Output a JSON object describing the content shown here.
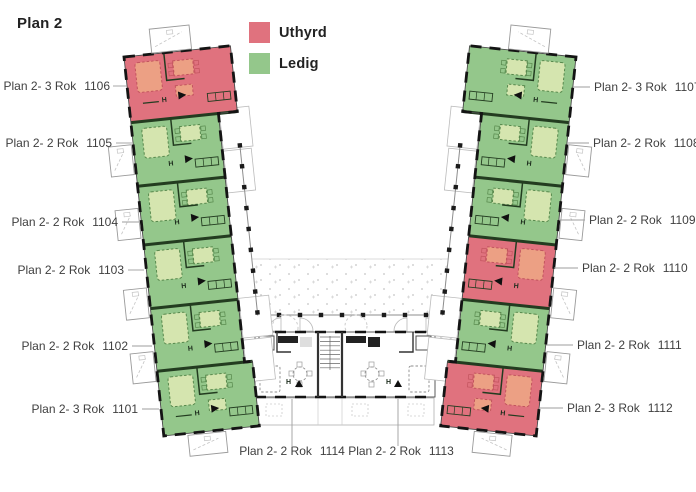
{
  "title": "Plan 2",
  "legend": {
    "items": [
      {
        "id": "uthyrd",
        "label": "Uthyrd",
        "color": "#e0727e"
      },
      {
        "id": "ledig",
        "label": "Ledig",
        "color": "#94c78b"
      }
    ]
  },
  "colors": {
    "uthyrd": "#e0727e",
    "ledig": "#94c78b",
    "uthyrd_furniture": "#eca084",
    "uthyrd_furniture_line": "#c2545e",
    "ledig_furniture": "#d5e5af",
    "ledig_furniture_line": "#57884c",
    "wing_wall": "#233c20",
    "neutral_wall": "#333333",
    "outline": "#4a4a4a",
    "window_dash": "#141414",
    "sketch": "#9a9a9a",
    "stipple": "#c4c4c4"
  },
  "plan": {
    "canvas": [
      696,
      492
    ],
    "wings": {
      "left": {
        "origin": [
          124,
          57
        ],
        "rotate": -6,
        "mirror": false
      },
      "right": {
        "origin": [
          576,
          57
        ],
        "rotate": 6,
        "mirror": true
      }
    },
    "cuts": [
      0,
      66,
      130,
      189,
      253,
      316,
      381
    ],
    "cell_widths": [
      107,
      88,
      88,
      88,
      88,
      96
    ],
    "gallery_x": 106,
    "railing_t": [
      100,
      271
    ],
    "balcony_t": [
      88,
      152,
      232,
      296
    ],
    "courtyard": {
      "bottom_wall": [
        258,
        315,
        442,
        315
      ],
      "stipple": [
        [
          252,
          259
        ],
        [
          448,
          259
        ],
        [
          442,
          314
        ],
        [
          258,
          314
        ]
      ],
      "stipple_top": [
        252,
        259,
        448,
        259
      ]
    },
    "bar": {
      "x": 255,
      "y": 332,
      "w": 180,
      "h": 65,
      "stair": [
        318,
        342
      ],
      "terrace": [
        256,
        398,
        178,
        27
      ]
    }
  },
  "apartments": [
    {
      "number": "1106",
      "rooms": "Plan 2- 3 Rok",
      "status": "uthyrd",
      "wing": "left",
      "slot": 0,
      "label": {
        "x": 110,
        "y": 90,
        "anchor": "end"
      },
      "connector": [
        113,
        86,
        127,
        86
      ]
    },
    {
      "number": "1105",
      "rooms": "Plan 2- 2 Rok",
      "status": "ledig",
      "wing": "left",
      "slot": 1,
      "label": {
        "x": 112,
        "y": 147,
        "anchor": "end"
      },
      "connector": [
        116,
        143,
        132,
        143
      ]
    },
    {
      "number": "1104",
      "rooms": "Plan 2- 2 Rok",
      "status": "ledig",
      "wing": "left",
      "slot": 2,
      "label": {
        "x": 118,
        "y": 226,
        "anchor": "end"
      },
      "connector": [
        122,
        222,
        139,
        222
      ]
    },
    {
      "number": "1103",
      "rooms": "Plan 2- 2 Rok",
      "status": "ledig",
      "wing": "left",
      "slot": 3,
      "label": {
        "x": 124,
        "y": 274,
        "anchor": "end"
      },
      "connector": [
        128,
        270,
        144,
        270
      ]
    },
    {
      "number": "1102",
      "rooms": "Plan 2- 2 Rok",
      "status": "ledig",
      "wing": "left",
      "slot": 4,
      "label": {
        "x": 128,
        "y": 350,
        "anchor": "end"
      },
      "connector": [
        132,
        346,
        152,
        346
      ]
    },
    {
      "number": "1101",
      "rooms": "Plan 2- 3 Rok",
      "status": "ledig",
      "wing": "left",
      "slot": 5,
      "label": {
        "x": 138,
        "y": 413,
        "anchor": "end"
      },
      "connector": [
        142,
        409,
        159,
        409
      ]
    },
    {
      "number": "1107",
      "rooms": "Plan 2- 3 Rok",
      "status": "ledig",
      "wing": "right",
      "slot": 0,
      "label": {
        "x": 594,
        "y": 91,
        "anchor": "start"
      },
      "connector": [
        573,
        87,
        590,
        87
      ]
    },
    {
      "number": "1108",
      "rooms": "Plan 2- 2 Rok",
      "status": "ledig",
      "wing": "right",
      "slot": 1,
      "label": {
        "x": 593,
        "y": 147,
        "anchor": "start"
      },
      "connector": [
        567,
        143,
        589,
        143
      ]
    },
    {
      "number": "1109",
      "rooms": "Plan 2- 2 Rok",
      "status": "ledig",
      "wing": "right",
      "slot": 2,
      "label": {
        "x": 589,
        "y": 224,
        "anchor": "start"
      },
      "connector": [
        559,
        220,
        585,
        220
      ]
    },
    {
      "number": "1110",
      "rooms": "Plan 2- 2 Rok",
      "status": "uthyrd",
      "wing": "right",
      "slot": 3,
      "label": {
        "x": 582,
        "y": 272,
        "anchor": "start"
      },
      "connector": [
        554,
        268,
        578,
        268
      ]
    },
    {
      "number": "1111",
      "rooms": "Plan 2- 2 Rok",
      "status": "ledig",
      "wing": "right",
      "slot": 4,
      "label": {
        "x": 577,
        "y": 349,
        "anchor": "start"
      },
      "connector": [
        546,
        345,
        573,
        345
      ]
    },
    {
      "number": "1112",
      "rooms": "Plan 2- 3 Rok",
      "status": "uthyrd",
      "wing": "right",
      "slot": 5,
      "label": {
        "x": 567,
        "y": 412,
        "anchor": "start"
      },
      "connector": [
        540,
        408,
        563,
        408
      ]
    },
    {
      "number": "1114",
      "rooms": "Plan 2- 2 Rok",
      "status": "none",
      "wing": "bottom",
      "slot": 0,
      "label": {
        "x": 292,
        "y": 455,
        "anchor": "middle"
      },
      "connector": [
        292,
        399,
        292,
        446
      ]
    },
    {
      "number": "1113",
      "rooms": "Plan 2- 2 Rok",
      "status": "none",
      "wing": "bottom",
      "slot": 1,
      "label": {
        "x": 401,
        "y": 455,
        "anchor": "middle"
      },
      "connector": [
        398,
        399,
        398,
        446
      ]
    }
  ]
}
